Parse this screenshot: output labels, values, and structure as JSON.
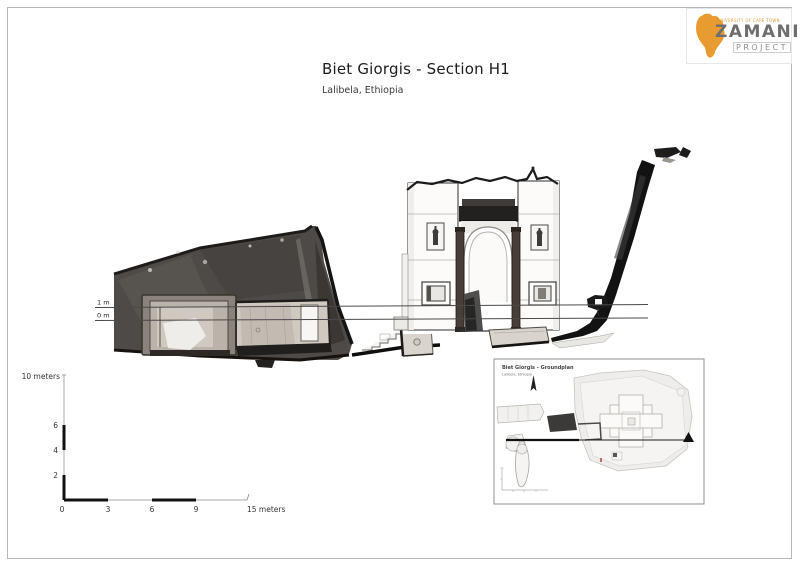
{
  "page": {
    "title": "Biet Giorgis - Section H1",
    "subtitle": "Lalibela, Ethiopia"
  },
  "logo": {
    "university": "UNIVERSITY OF CAPE TOWN",
    "name": "ZAMANI",
    "project": "PROJECT"
  },
  "section": {
    "datum_labels": {
      "upper": "1 m",
      "lower": "0 m"
    }
  },
  "scales": {
    "vertical": {
      "top_label": "10 meters",
      "tick_6": "6",
      "tick_4": "4",
      "tick_2": "2"
    },
    "horizontal": {
      "tick_0": "0",
      "tick_3": "3",
      "tick_6": "6",
      "tick_9": "9",
      "end_label": "15 meters"
    }
  },
  "inset": {
    "title": "Biet Giorgis - Groundplan",
    "subtitle": "Lalibela, Ethiopia"
  },
  "colors": {
    "logo_orange": "#E89B30",
    "ink": "#1a1a1a",
    "rock_gray": "#4e4a47",
    "light_stone": "#cfc9c0"
  },
  "icons": [
    "africa-map-icon",
    "north-arrow-icon",
    "section-arrow-icon"
  ]
}
